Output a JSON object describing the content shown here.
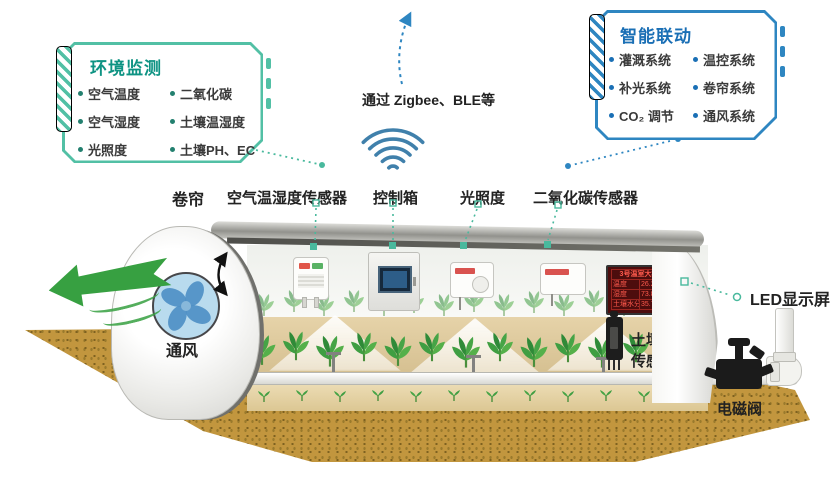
{
  "env_panel": {
    "title": "环境监测",
    "items": [
      "空气温度",
      "二氧化碳",
      "空气湿度",
      "土壤温湿度",
      "光照度",
      "土壤PH、EC"
    ]
  },
  "link_panel": {
    "title": "智能联动",
    "items": [
      "灌溉系统",
      "温控系统",
      "补光系统",
      "卷帘系统",
      "CO₂ 调节",
      "通风系统"
    ]
  },
  "transport": {
    "label": "通过 Zigbee、BLE等"
  },
  "scene_labels": {
    "roller": "卷帘",
    "air_sensor": "空气温湿度传感器",
    "control_box": "控制箱",
    "light": "光照度",
    "co2_sensor": "二氧化碳传感器",
    "ventilation": "通风",
    "led_screen": "LED显示屏",
    "soil_line1": "土壤温湿度",
    "soil_line2": "传感器",
    "valve": "电磁阀"
  },
  "led_display": {
    "title": "3号温室大棚",
    "rows": [
      {
        "k": "温度",
        "v": "26.2℃"
      },
      {
        "k": "湿度",
        "v": "73.8%RH"
      },
      {
        "k": "土壤水分",
        "v": "35.7%"
      }
    ]
  },
  "icons": [
    "wifi-signal-icon",
    "up-dashed-arrow-icon",
    "fan-icon",
    "left-green-arrow-icon",
    "roller-double-arrow-icon"
  ],
  "colors": {
    "teal": "#52c0a5",
    "teal_dark": "#0e9383",
    "blue": "#2e86c1",
    "blue_dark": "#1a6fb5",
    "green_arrow": "#37a041",
    "led_red": "#ff5a4d",
    "dirt": "#c2963e"
  }
}
